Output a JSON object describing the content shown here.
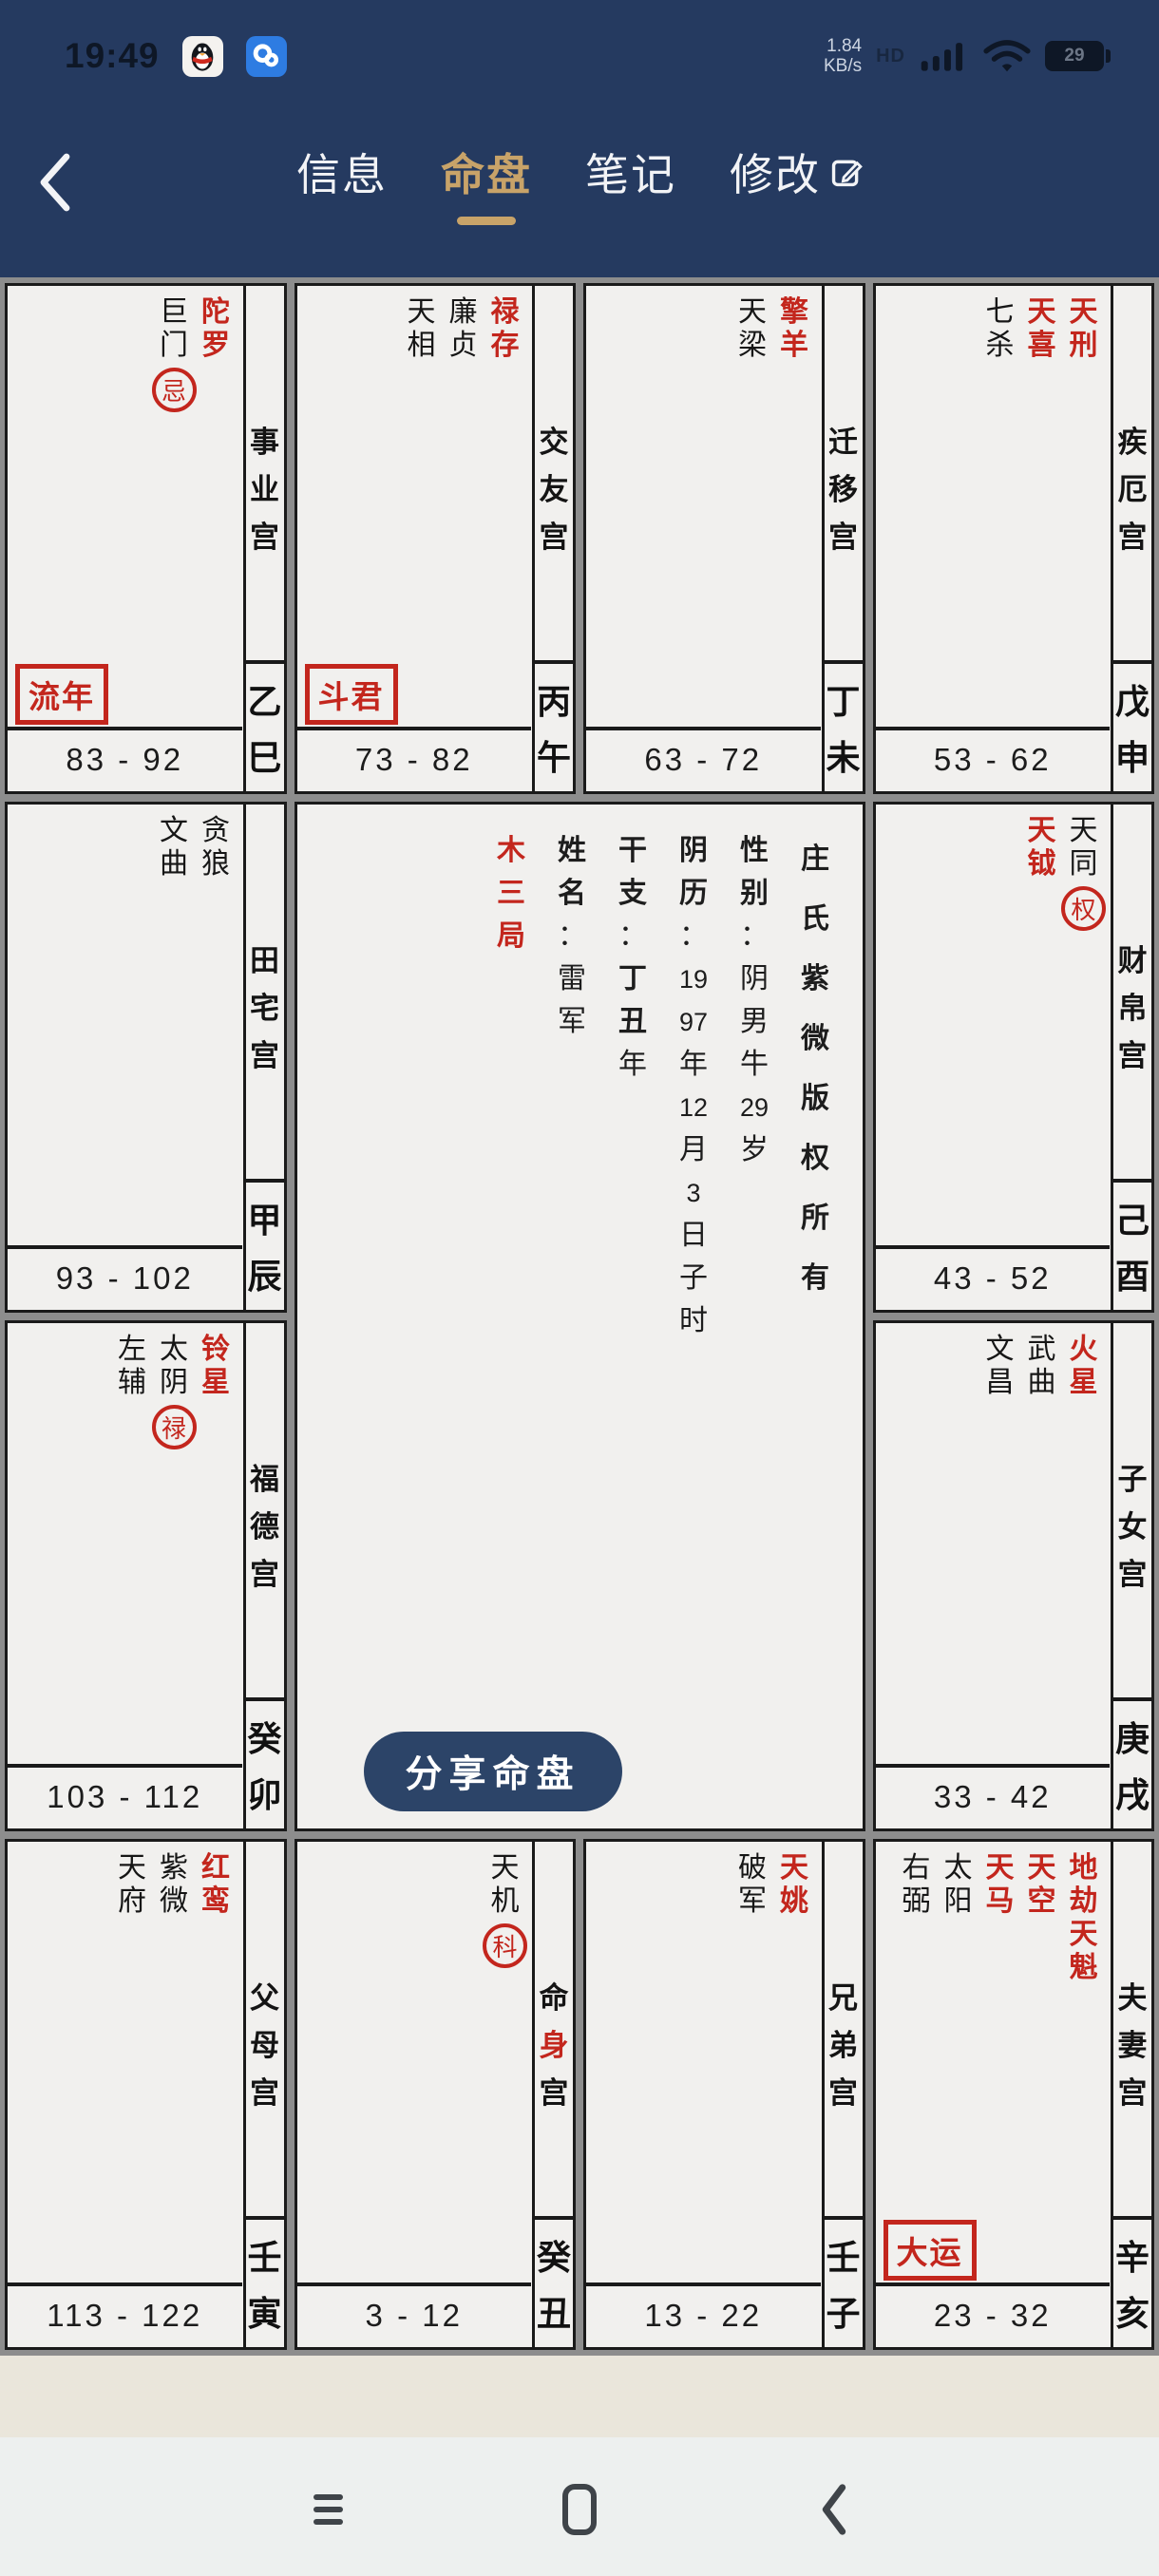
{
  "status_bar": {
    "time": "19:49",
    "net_speed_value": "1.84",
    "net_speed_unit": "KB/s",
    "hd_label": "HD",
    "battery_percent": "29",
    "icons": [
      "qq-icon",
      "weiyun-cloud-icon",
      "hd-icon",
      "signal-icon",
      "wifi-icon",
      "battery-icon"
    ]
  },
  "nav": {
    "back_icon": "chevron-left-icon",
    "tabs": [
      {
        "label": "信息",
        "active": false
      },
      {
        "label": "命盘",
        "active": true
      },
      {
        "label": "笔记",
        "active": false
      },
      {
        "label": "修改",
        "active": false,
        "edit_icon": true
      }
    ]
  },
  "colors": {
    "navy": "#253a60",
    "gold": "#c8a369",
    "red": "#c3261d",
    "cell_bg": "#f1f0ee",
    "cell_border": "#1a1a1a",
    "backdrop": "#8d8d8d",
    "share_bg": "#2c4468"
  },
  "share_button": {
    "label": "分享命盘"
  },
  "center": {
    "columns": [
      {
        "id": "bureau",
        "red": true,
        "tokens": [
          {
            "t": "木"
          },
          {
            "t": "三"
          },
          {
            "t": "局"
          }
        ]
      },
      {
        "id": "name",
        "tokens": [
          {
            "t": "姓",
            "b": 1
          },
          {
            "t": "名",
            "b": 1
          },
          {
            "t": "："
          },
          {
            "t": "雷"
          },
          {
            "t": "军"
          }
        ]
      },
      {
        "id": "ganzhi",
        "tokens": [
          {
            "t": "干",
            "b": 1
          },
          {
            "t": "支",
            "b": 1
          },
          {
            "t": "："
          },
          {
            "t": "丁",
            "b": 1
          },
          {
            "t": "丑",
            "b": 1
          },
          {
            "t": "年"
          }
        ]
      },
      {
        "id": "lunar-date",
        "tokens": [
          {
            "t": "阴",
            "b": 1
          },
          {
            "t": "历",
            "b": 1
          },
          {
            "t": "："
          },
          {
            "t": "19"
          },
          {
            "t": "97"
          },
          {
            "t": "年"
          },
          {
            "t": "12"
          },
          {
            "t": "月"
          },
          {
            "t": "3"
          },
          {
            "t": "日"
          },
          {
            "t": "子"
          },
          {
            "t": "时"
          }
        ]
      },
      {
        "id": "gender",
        "tokens": [
          {
            "t": "性",
            "b": 1
          },
          {
            "t": "别",
            "b": 1
          },
          {
            "t": "："
          },
          {
            "t": "阴"
          },
          {
            "t": "男"
          },
          {
            "t": "牛"
          },
          {
            "t": "29"
          },
          {
            "t": "岁"
          }
        ]
      },
      {
        "id": "copyright",
        "loose": true,
        "tokens": [
          {
            "t": "庄"
          },
          {
            "t": "氏"
          },
          {
            "t": "紫"
          },
          {
            "t": "微"
          },
          {
            "t": "版"
          },
          {
            "t": "权"
          },
          {
            "t": "所"
          },
          {
            "t": "有"
          }
        ]
      }
    ]
  },
  "palaces": [
    {
      "id": "career",
      "row": 1,
      "col": 1,
      "name": [
        {
          "t": "事"
        },
        {
          "t": "业"
        },
        {
          "t": "宫"
        }
      ],
      "stars": [
        {
          "t": "巨门",
          "hua": "忌"
        },
        {
          "t": "陀罗",
          "r": 1
        }
      ],
      "badge": "流年",
      "age": "83 - 92",
      "gz": "乙巳"
    },
    {
      "id": "friends",
      "row": 1,
      "col": 2,
      "name": [
        {
          "t": "交"
        },
        {
          "t": "友"
        },
        {
          "t": "宫"
        }
      ],
      "stars": [
        {
          "t": "天相"
        },
        {
          "t": "廉贞"
        },
        {
          "t": "禄存",
          "r": 1
        }
      ],
      "badge": "斗君",
      "age": "73 - 82",
      "gz": "丙午"
    },
    {
      "id": "travel",
      "row": 1,
      "col": 3,
      "name": [
        {
          "t": "迁"
        },
        {
          "t": "移"
        },
        {
          "t": "宫"
        }
      ],
      "stars": [
        {
          "t": "天梁"
        },
        {
          "t": "擎羊",
          "r": 1
        }
      ],
      "age": "63 - 72",
      "gz": "丁未"
    },
    {
      "id": "health",
      "row": 1,
      "col": 4,
      "name": [
        {
          "t": "疾"
        },
        {
          "t": "厄"
        },
        {
          "t": "宫"
        }
      ],
      "stars": [
        {
          "t": "七杀"
        },
        {
          "t": "天喜",
          "r": 1
        },
        {
          "t": "天刑",
          "r": 1
        }
      ],
      "age": "53 - 62",
      "gz": "戊申"
    },
    {
      "id": "property",
      "row": 2,
      "col": 1,
      "name": [
        {
          "t": "田"
        },
        {
          "t": "宅"
        },
        {
          "t": "宫"
        }
      ],
      "stars": [
        {
          "t": "文曲"
        },
        {
          "t": "贪狼"
        }
      ],
      "age": "93 - 102",
      "gz": "甲辰"
    },
    {
      "id": "wealth",
      "row": 2,
      "col": 4,
      "name": [
        {
          "t": "财"
        },
        {
          "t": "帛"
        },
        {
          "t": "宫"
        }
      ],
      "stars": [
        {
          "t": "天钺",
          "r": 1
        },
        {
          "t": "天同",
          "hua": "权"
        }
      ],
      "age": "43 - 52",
      "gz": "己酉"
    },
    {
      "id": "fortune",
      "row": 3,
      "col": 1,
      "name": [
        {
          "t": "福"
        },
        {
          "t": "德"
        },
        {
          "t": "宫"
        }
      ],
      "stars": [
        {
          "t": "左辅"
        },
        {
          "t": "太阴",
          "hua": "禄"
        },
        {
          "t": "铃星",
          "r": 1
        }
      ],
      "age": "103 - 112",
      "gz": "癸卯"
    },
    {
      "id": "children",
      "row": 3,
      "col": 4,
      "name": [
        {
          "t": "子"
        },
        {
          "t": "女"
        },
        {
          "t": "宫"
        }
      ],
      "stars": [
        {
          "t": "文昌"
        },
        {
          "t": "武曲"
        },
        {
          "t": "火星",
          "r": 1
        }
      ],
      "age": "33 - 42",
      "gz": "庚戌"
    },
    {
      "id": "parents",
      "row": 4,
      "col": 1,
      "name": [
        {
          "t": "父"
        },
        {
          "t": "母"
        },
        {
          "t": "宫"
        }
      ],
      "stars": [
        {
          "t": "天府"
        },
        {
          "t": "紫微"
        },
        {
          "t": "红鸾",
          "r": 1
        }
      ],
      "age": "113 - 122",
      "gz": "壬寅"
    },
    {
      "id": "life-body",
      "row": 4,
      "col": 2,
      "name": [
        {
          "t": "命"
        },
        {
          "t": "身",
          "r": 1
        },
        {
          "t": "宫"
        }
      ],
      "stars": [
        {
          "t": "天机",
          "hua": "科"
        }
      ],
      "age": "3 - 12",
      "gz": "癸丑"
    },
    {
      "id": "siblings",
      "row": 4,
      "col": 3,
      "name": [
        {
          "t": "兄"
        },
        {
          "t": "弟"
        },
        {
          "t": "宫"
        }
      ],
      "stars": [
        {
          "t": "破军"
        },
        {
          "t": "天姚",
          "r": 1
        }
      ],
      "age": "13 - 22",
      "gz": "壬子"
    },
    {
      "id": "spouse",
      "row": 4,
      "col": 4,
      "name": [
        {
          "t": "夫"
        },
        {
          "t": "妻"
        },
        {
          "t": "宫"
        }
      ],
      "stars": [
        {
          "t": "右弼"
        },
        {
          "t": "太阳"
        },
        {
          "t": "天马",
          "r": 1
        },
        {
          "t": "天空",
          "r": 1
        },
        {
          "t": "地劫天魁",
          "r": 1
        }
      ],
      "badge": "大运",
      "age": "23 - 32",
      "gz": "辛亥"
    }
  ],
  "system_nav": {
    "icons": [
      "recent-apps-icon",
      "home-icon",
      "back-icon"
    ]
  }
}
